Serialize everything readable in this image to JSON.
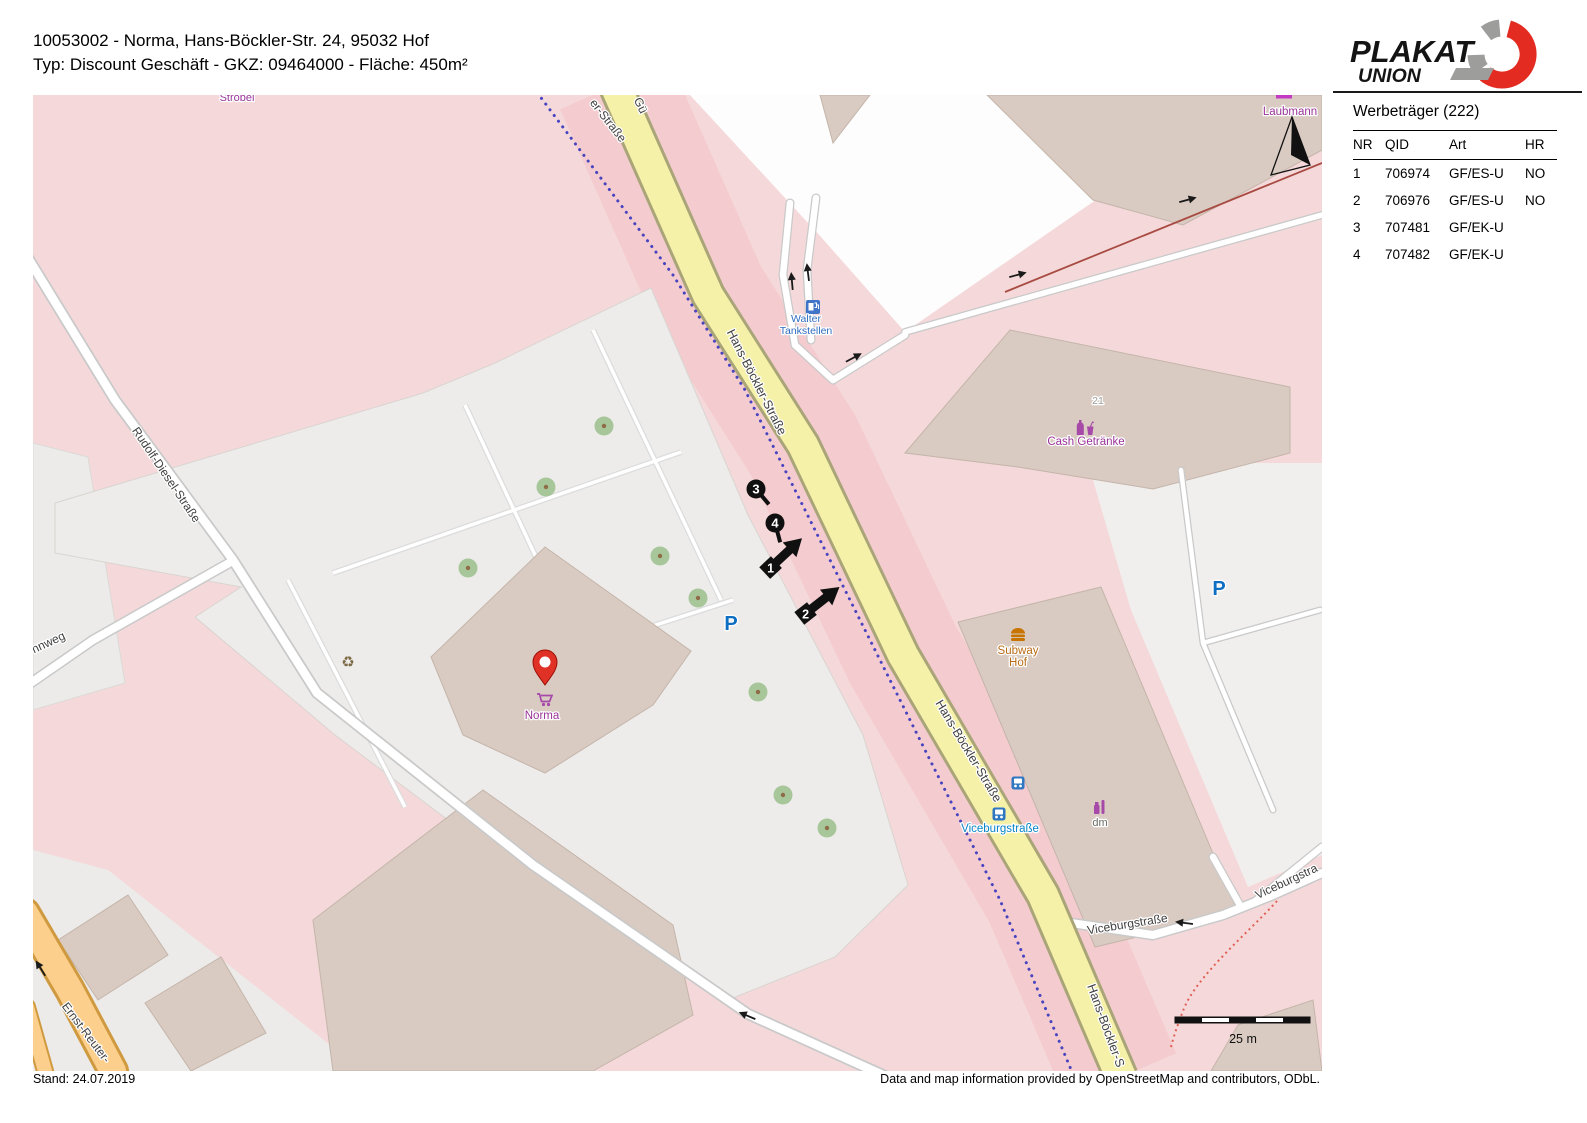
{
  "header": {
    "line1": "10053002 - Norma, Hans-Böckler-Str. 24, 95032 Hof",
    "line2": "Typ: Discount Geschäft - GKZ: 09464000 - Fläche: 450m²",
    "logo_line1": "PLAKAT",
    "logo_line2": "UNION"
  },
  "sidebar": {
    "title": "Werbeträger (222)",
    "columns": [
      "NR",
      "QID",
      "Art",
      "HR"
    ],
    "rows": [
      [
        "1",
        "706974",
        "GF/ES-U",
        "NO"
      ],
      [
        "2",
        "706976",
        "GF/ES-U",
        "NO"
      ],
      [
        "3",
        "707481",
        "GF/EK-U",
        ""
      ],
      [
        "4",
        "707482",
        "GF/EK-U",
        ""
      ]
    ]
  },
  "footer": {
    "left": "Stand: 24.07.2019",
    "right": "Data and map information provided by OpenStreetMap and contributors, ODbL."
  },
  "colors": {
    "brand_red": "#e32b22",
    "logo_gray": "#9d9d9c",
    "road_yellow": "#f6f1a9",
    "map_pink": "#f5d9da",
    "corridor_pink": "#f4cbce",
    "building": "#d9cbc2",
    "parking": "#eeeceb",
    "boundary_blue": "#4844bf",
    "orange_road": "#fdcf8c",
    "tree_green": "#a7c79b",
    "poi_purple": "#993399",
    "transit_blue": "#0a85c7",
    "street_label": "#3f3f3f"
  },
  "map": {
    "scale_text": "25 m",
    "labels": [
      {
        "text": "Ströbel",
        "x": 204,
        "y": 6,
        "rot": 0,
        "color": "#993399",
        "size": 11
      },
      {
        "text": "Laubmann",
        "x": 1257,
        "y": 20,
        "rot": 0,
        "color": "#993399",
        "size": 11.5
      },
      {
        "text": "er-Straße",
        "x": 572,
        "y": 28,
        "rot": 52,
        "color": "#3f3f3f",
        "size": 12
      },
      {
        "text": "Gü",
        "x": 604,
        "y": 12,
        "rot": 65,
        "color": "#3f3f3f",
        "size": 12
      },
      {
        "text": "Hans-Böckler-Straße",
        "x": 720,
        "y": 289,
        "rot": 63,
        "color": "#3f3f3f",
        "size": 12.5
      },
      {
        "text": "Hans-Böckler-Straße",
        "x": 932,
        "y": 658,
        "rot": 59,
        "color": "#3f3f3f",
        "size": 12.5
      },
      {
        "text": "Hans-Böckler-S",
        "x": 1069,
        "y": 932,
        "rot": 70,
        "color": "#3f3f3f",
        "size": 12.5
      },
      {
        "text": "Rudolf-Diesel-Straße",
        "x": 130,
        "y": 382,
        "rot": 56,
        "color": "#3f3f3f",
        "size": 12
      },
      {
        "text": "nnweg",
        "x": 17,
        "y": 551,
        "rot": -25,
        "color": "#3f3f3f",
        "size": 12
      },
      {
        "text": "Ernst-Reuter-",
        "x": 50,
        "y": 940,
        "rot": 53,
        "color": "#3f3f3f",
        "size": 12
      },
      {
        "text": "Viceburgstraße",
        "x": 1095,
        "y": 833,
        "rot": -9,
        "color": "#3f3f3f",
        "size": 12
      },
      {
        "text": "Viceburgstra",
        "x": 1255,
        "y": 790,
        "rot": -25,
        "color": "#3f3f3f",
        "size": 12
      },
      {
        "text": "Viceburgstraße",
        "x": 967,
        "y": 737,
        "rot": 0,
        "color": "#0a85c7",
        "size": 11.5
      },
      {
        "text": "Walter",
        "x": 773,
        "y": 227,
        "rot": 0,
        "color": "#2d6cc0",
        "size": 10.5
      },
      {
        "text": "Tankstellen",
        "x": 773,
        "y": 239,
        "rot": 0,
        "color": "#2d6cc0",
        "size": 10.5
      },
      {
        "text": "Cash Getränke",
        "x": 1053,
        "y": 350,
        "rot": 0,
        "color": "#993399",
        "size": 11.5
      },
      {
        "text": "21",
        "x": 1065,
        "y": 309,
        "rot": 0,
        "color": "#9b9b9b",
        "size": 10.5
      },
      {
        "text": "Subway",
        "x": 985,
        "y": 559,
        "rot": 0,
        "color": "#b96c16",
        "size": 11.5
      },
      {
        "text": "Hof",
        "x": 985,
        "y": 571,
        "rot": 0,
        "color": "#b96c16",
        "size": 11.5
      },
      {
        "text": "dm",
        "x": 1067,
        "y": 731,
        "rot": 0,
        "color": "#6b6b64",
        "size": 11
      },
      {
        "text": "Norma",
        "x": 509,
        "y": 624,
        "rot": 0,
        "color": "#993399",
        "size": 11.5
      },
      {
        "text": "P",
        "x": 698,
        "y": 535,
        "rot": 0,
        "color": "#0d6ec2",
        "size": 20,
        "weight": "bold"
      },
      {
        "text": "P",
        "x": 1186,
        "y": 500,
        "rot": 0,
        "color": "#0d6ec2",
        "size": 20,
        "weight": "bold"
      }
    ],
    "poi_icons": [
      {
        "type": "fuel-icon",
        "x": 780,
        "y": 212
      },
      {
        "type": "bottle-drink-icon",
        "x": 1052,
        "y": 333
      },
      {
        "type": "burger-icon",
        "x": 985,
        "y": 540
      },
      {
        "type": "chemist-icon",
        "x": 1067,
        "y": 712
      },
      {
        "type": "bus-icon",
        "x": 985,
        "y": 688
      },
      {
        "type": "bus-icon",
        "x": 966,
        "y": 719
      },
      {
        "type": "pin-icon",
        "x": 512,
        "y": 590
      },
      {
        "type": "cart-icon",
        "x": 512,
        "y": 605
      },
      {
        "type": "recycle-icon",
        "x": 315,
        "y": 567
      }
    ],
    "trees": [
      [
        571,
        331
      ],
      [
        513,
        392
      ],
      [
        435,
        473
      ],
      [
        627,
        461
      ],
      [
        665,
        503
      ],
      [
        725,
        597
      ],
      [
        750,
        700
      ],
      [
        794,
        733
      ]
    ],
    "oneway_arrows": [
      [
        759,
        187,
        -95
      ],
      [
        775,
        178,
        -97
      ],
      [
        820,
        263,
        -28
      ],
      [
        984,
        180,
        -15
      ],
      [
        1154,
        105,
        -15
      ],
      [
        715,
        921,
        203
      ],
      [
        1152,
        828,
        187
      ],
      [
        8,
        874,
        -122
      ]
    ],
    "markers": [
      {
        "label": "1",
        "type": "arrow",
        "x": 750,
        "y": 461,
        "rot": -43
      },
      {
        "label": "2",
        "type": "arrow",
        "x": 786,
        "y": 508,
        "rot": -38
      },
      {
        "label": "3",
        "type": "dot",
        "x": 723,
        "y": 394,
        "tail": 50
      },
      {
        "label": "4",
        "type": "dot",
        "x": 742,
        "y": 428,
        "tail": 75
      }
    ]
  }
}
